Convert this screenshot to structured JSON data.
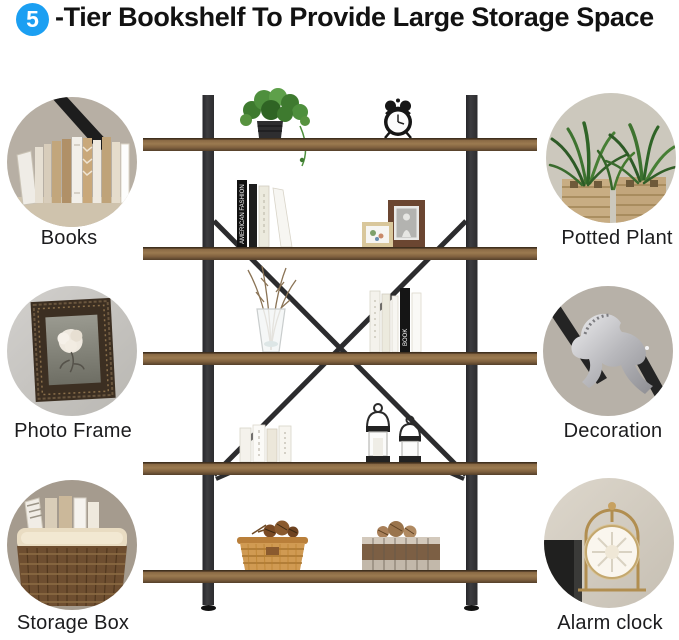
{
  "header": {
    "badge": "5",
    "title": "-Tier Bookshelf To Provide Large Storage Space"
  },
  "features": {
    "left": [
      {
        "label": "Books",
        "icon": "books-photo"
      },
      {
        "label": "Photo Frame",
        "icon": "photo-frame-photo"
      },
      {
        "label": "Storage Box",
        "icon": "storage-box-photo"
      }
    ],
    "right": [
      {
        "label": "Potted Plant",
        "icon": "potted-plant-photo"
      },
      {
        "label": "Decoration",
        "icon": "decoration-photo"
      },
      {
        "label": "Alarm clock",
        "icon": "alarm-clock-photo"
      }
    ]
  },
  "bookshelf": {
    "tiers": 5,
    "book_spine_text": "AMERICAN FASHION",
    "book_spine_text_2": "BOOK",
    "decor_items": [
      "potted-plant",
      "alarm-clock",
      "standing-books",
      "photo-frames",
      "glass-vase-with-branches",
      "standing-books",
      "white-books",
      "candle-lanterns",
      "wicker-basket-with-pinecones",
      "wooden-crate-with-pinecones"
    ]
  },
  "colors": {
    "badge_blue": "#1b9ff2",
    "shelf_wood": "#8a6a45",
    "frame_metal": "#39393b"
  }
}
